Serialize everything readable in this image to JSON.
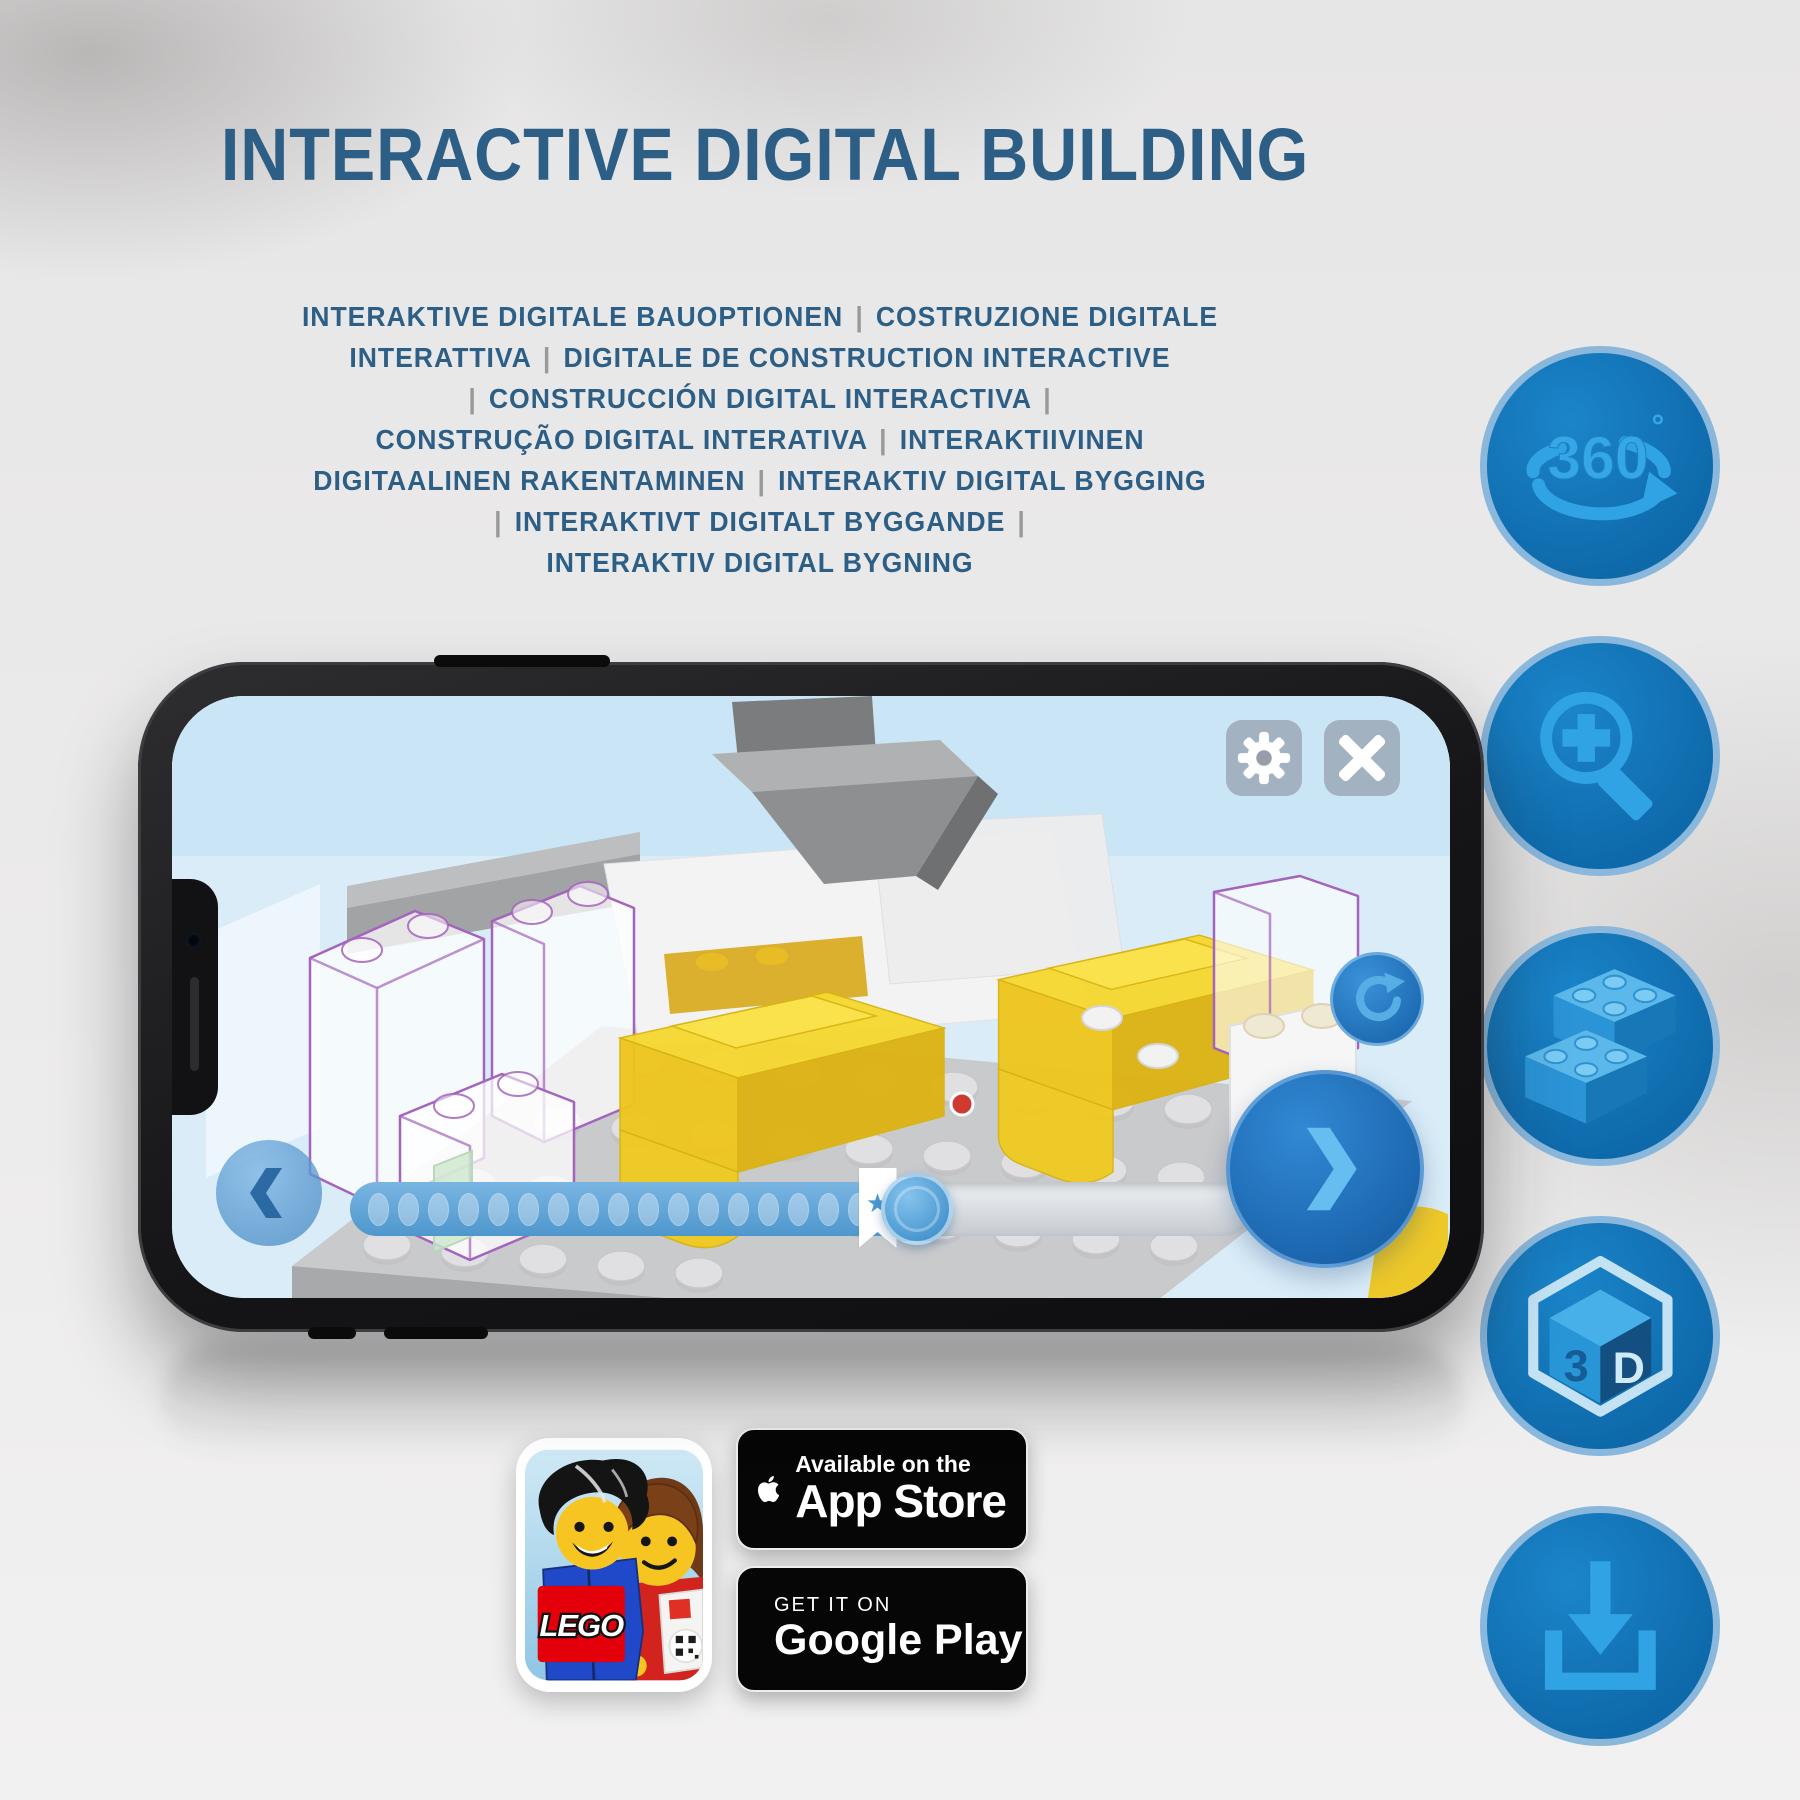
{
  "title": "INTERACTIVE DIGITAL BUILDING",
  "subtitle_lines": [
    "INTERAKTIVE DIGITALE BAUOPTIONEN | COSTRUZIONE DIGITALE",
    "INTERATTIVA | DIGITALE DE CONSTRUCTION INTERACTIVE",
    "| CONSTRUCCIÓN DIGITAL INTERACTIVA |",
    "CONSTRUÇÃO DIGITAL INTERATIVA | INTERAKTIIVINEN",
    "DIGITAALINEN RAKENTAMINEN | INTERAKTIV DIGITAL BYGGING",
    "| INTERAKTIVT DIGITALT BYGGANDE |",
    "INTERAKTIV DIGITAL BYGNING"
  ],
  "feature_icons": {
    "rotation_360": {
      "number": "360",
      "degree": "°"
    },
    "cube_3d": {
      "left": "3",
      "right": "D"
    }
  },
  "phone": {
    "progress": {
      "star_marker": "★"
    }
  },
  "store_badges": {
    "app_store": {
      "tagline": "Available on the",
      "store": "App Store"
    },
    "google_play": {
      "tagline": "GET IT ON",
      "store": "Google Play"
    }
  },
  "app_icon": {
    "logo_text": "LEGO"
  },
  "colors": {
    "heading": "#2d5f86",
    "separator": "#97999b",
    "icon_circle": "#1173b8",
    "icon_circle_border": "#8ab8dd",
    "icon_glyph": "#2fa3e4",
    "yellow_brick": "#f6d831",
    "ghost_outline": "#a463bd",
    "badge_background": "#060606"
  }
}
